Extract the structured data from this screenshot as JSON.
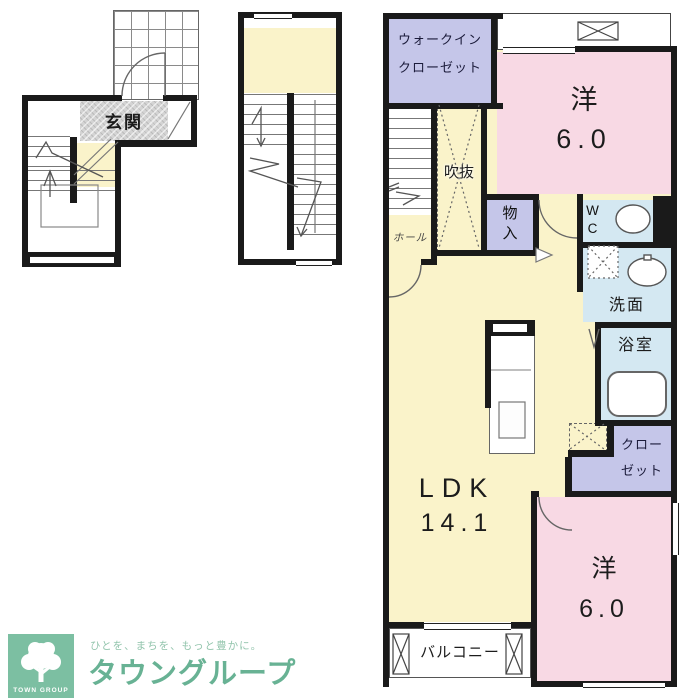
{
  "colors": {
    "wall": "#1a1a1a",
    "room_pink": "#f8d9e4",
    "room_yellow": "#faf3ca",
    "room_lavender": "#c5c6e9",
    "room_blue": "#d4e8f2",
    "genkan_gray": "#d4d4d4",
    "logo_green": "#68b294",
    "logo_green_light": "#93c5ad",
    "logo_square_green": "#7cbfa2"
  },
  "plan_1f": {
    "genkan_label": "玄関"
  },
  "plan_2f": {
    "walkin_closet_line1": "ウォークイン",
    "walkin_closet_line2": "クローゼット",
    "bedroom_top_name": "洋",
    "bedroom_top_size": "6.0",
    "void_label": "吹抜",
    "hall_label": "ホール",
    "storage_label": "物入",
    "wc_label": "WC",
    "washroom_label": "洗面",
    "bathroom_label": "浴室",
    "closet_line1": "クロー",
    "closet_line2": "ゼット",
    "ldk_name": "LDK",
    "ldk_size": "14.1",
    "bedroom_bottom_name": "洋",
    "bedroom_bottom_size": "6.0",
    "balcony_label": "バルコニー"
  },
  "logo": {
    "tagline": "ひとを、まちを、もっと豊かに。",
    "brand_name": "タウングループ",
    "mark_text": "TOWN GROUP"
  }
}
